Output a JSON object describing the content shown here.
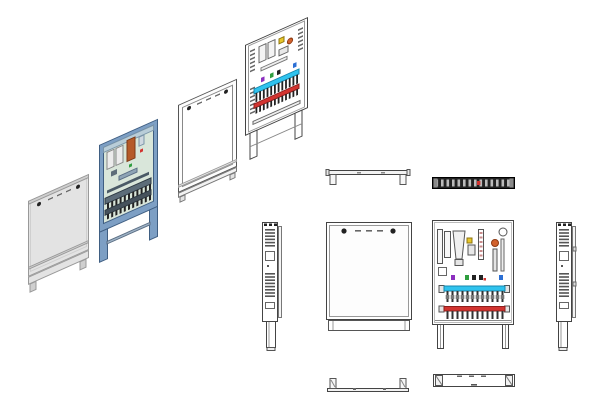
{
  "drawing": {
    "subject": "manifold-cabinet-technical-drawing",
    "style": "exploded-isometric-and-orthographic-views"
  },
  "colors": {
    "line": "#444444",
    "line_light": "#999999",
    "panel_gray": "#e3e3e3",
    "panel_gray_dark": "#cfcfcf",
    "frame_blue": "#7d9fc4",
    "frame_blue_dark": "#3f5e82",
    "interior_mint": "#d9e6da",
    "copper_orange": "#b55a28",
    "cylinder_white": "#ececec",
    "supply_cyan": "#2fc3ee",
    "supply_cyan_dark": "#1787ad",
    "return_red": "#d23430",
    "return_red_dark": "#8d1f1d",
    "valve_yellow": "#e7c629",
    "component_orange": "#d2622d",
    "actuator_purple": "#8c2fbf",
    "valve_green": "#2f9e3f",
    "valve_blue": "#2c6fd4",
    "dark_part": "#222222",
    "mid_gray": "#666666",
    "manifold_band": "#5d6d79",
    "top_tick_gray": "#bbbbbb"
  },
  "counts": {
    "supply_ports": 12,
    "return_ports": 12,
    "iso_ports": 11,
    "iso_vent_upper": 6,
    "iso_vent_lower": 7,
    "side_vent_upper": 6,
    "side_vent_lower": 8,
    "top_ticks": 14,
    "door_dashes": 3,
    "meter_stripes": 6
  }
}
